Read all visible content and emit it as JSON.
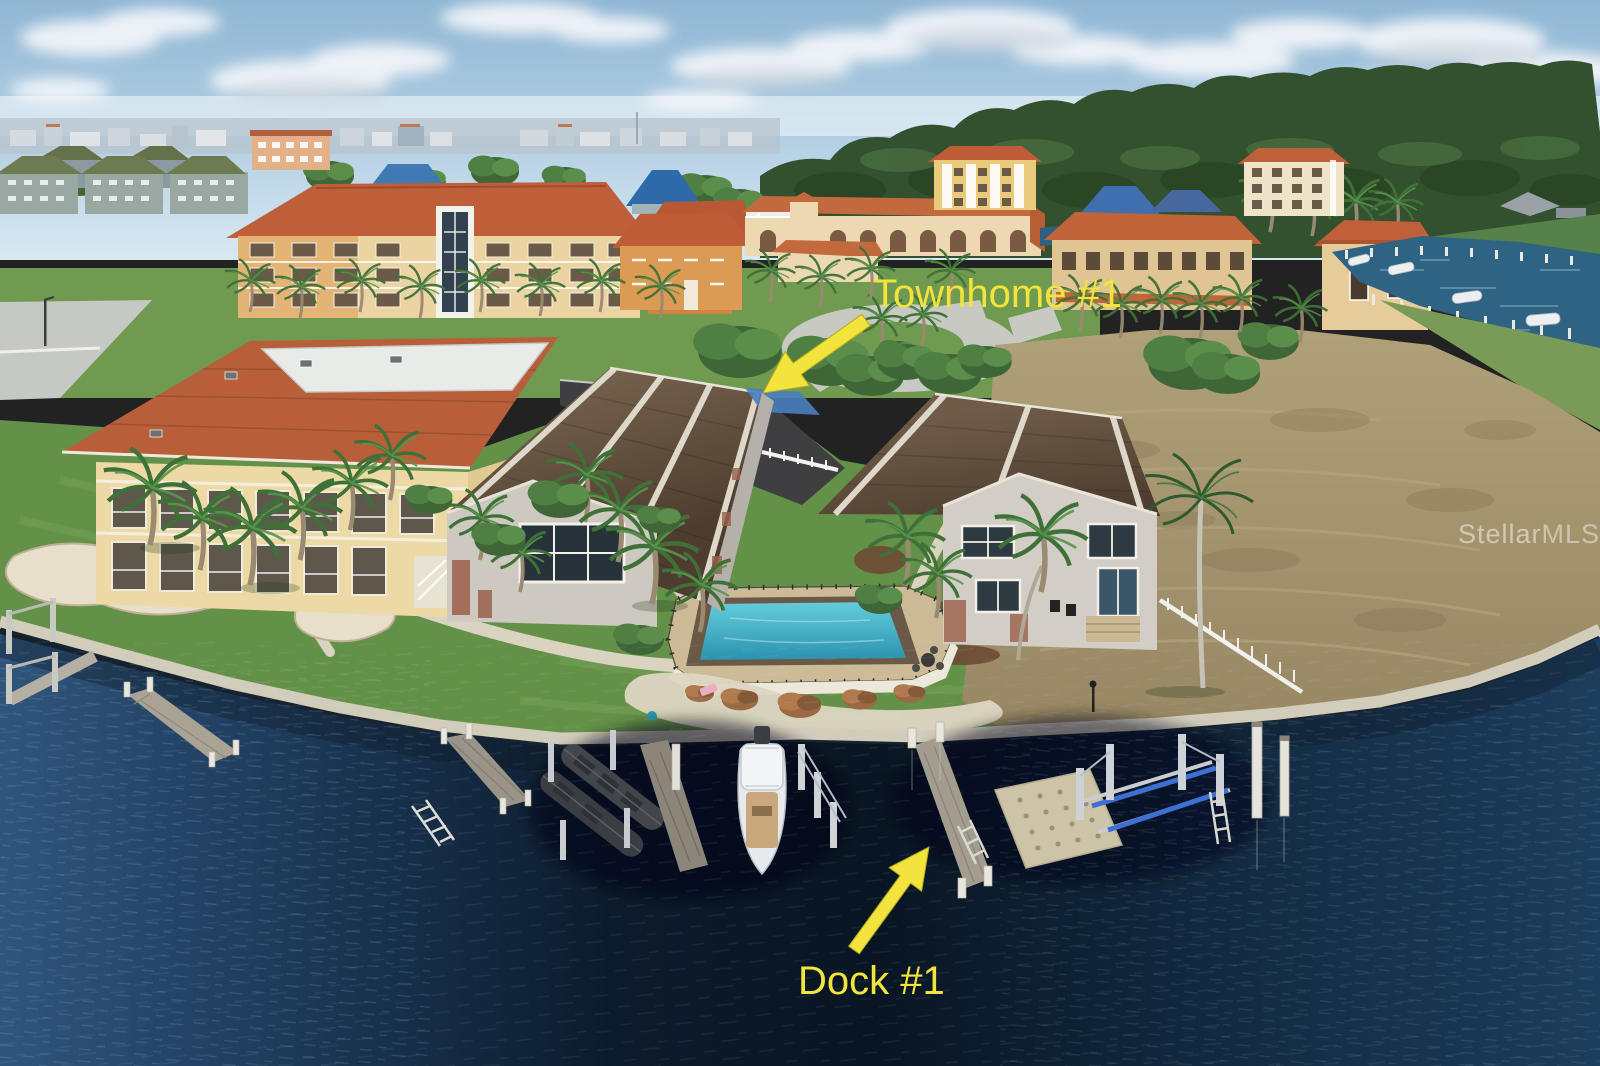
{
  "annotations": {
    "townhome": {
      "label": "Townhome #1"
    },
    "dock": {
      "label": "Dock #1"
    },
    "color": "#f2e43c"
  },
  "watermark": {
    "prefix": "Stellar",
    "suffix": "MLS"
  },
  "palette": {
    "sky_top": "#93b9d6",
    "sky_horizon": "#d9e9f2",
    "cloud": "#f5f8fa",
    "treeline": "#33502f",
    "lawn_green": "#649148",
    "dry_field": "#a3916b",
    "terracotta_roof": "#c0603a",
    "cream_wall": "#ead7a6",
    "townhome_roof": "#5f4c3b",
    "townhome_wall": "#cdc9c1",
    "pool_water": "#45b5cc",
    "pool_deck": "#cdbb97",
    "canal_water": "#2e6384",
    "harbor_water_dark": "#0a1725",
    "harbor_water_light": "#30557c",
    "seawall": "#d2ccbb",
    "dock_gray": "#a39d90",
    "piling_white": "#e9e7de",
    "boat_white": "#e7eaec",
    "annotation_yellow": "#f2e43c"
  }
}
